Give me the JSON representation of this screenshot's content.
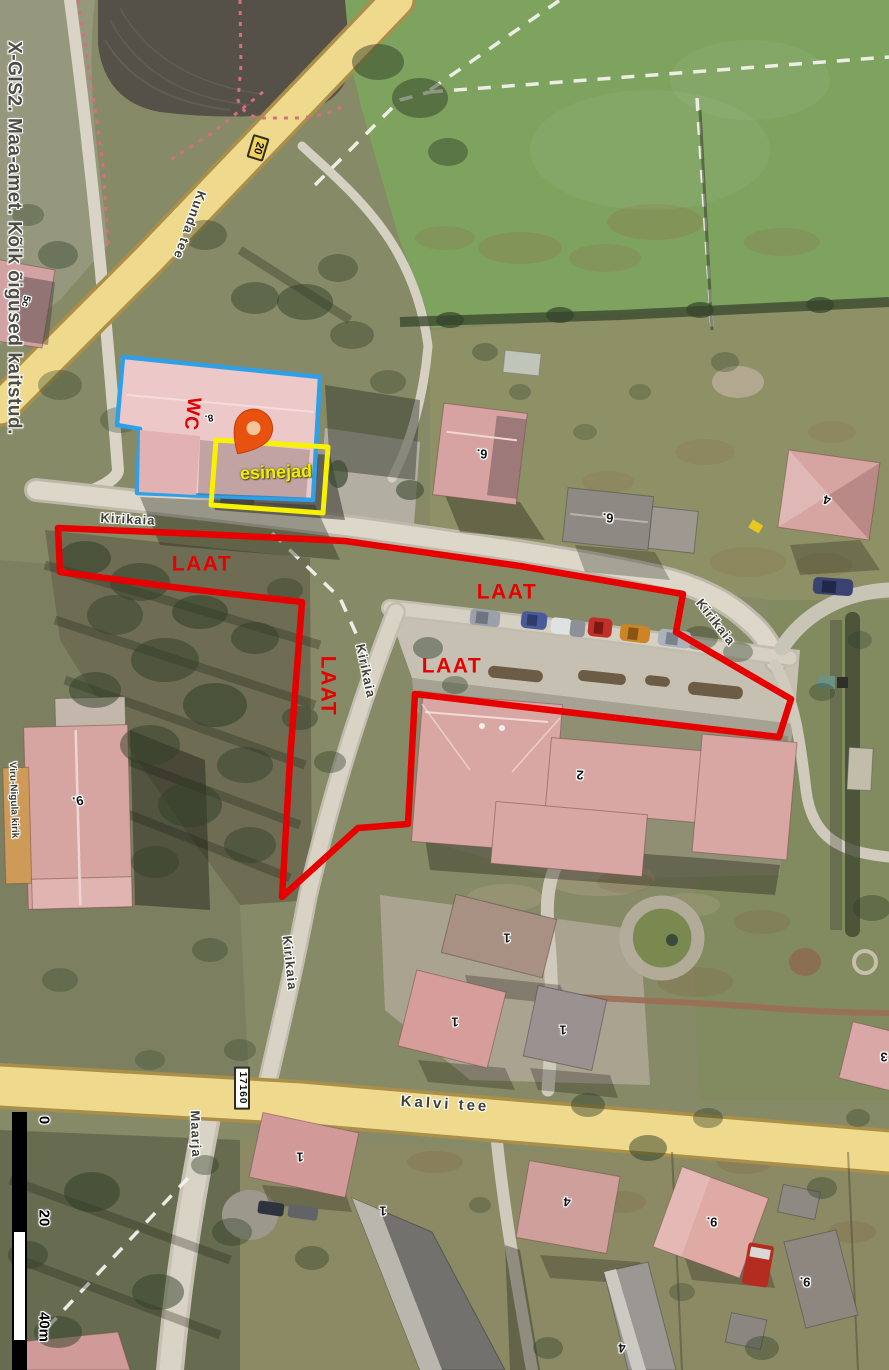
{
  "copyright": "X-GIS2. Maa-amet. Kõik õigused kaitstud.",
  "annotations": {
    "laat1": "LAAT",
    "laat2": "LAAT",
    "laat3": "LAAT",
    "laat4": "LAAT",
    "wc": "WC",
    "esinejad": "esinejad",
    "colors": {
      "event_area_outline": "#e60000",
      "wc_building_outline": "#2f9fe8",
      "stage_area_outline": "#f8f200",
      "location_pin": "#e8520e"
    }
  },
  "roads": {
    "kunda_tee": "Kunda tee",
    "kirikaia": "Kirikaia",
    "kalvi_tee": "Kalvi tee",
    "maarja": "Maarja",
    "route_number_20": "20",
    "route_number_17160": "17160"
  },
  "buildings": {
    "church_name": "Viru-Nigula kirik",
    "labels": {
      "wc_house": "8.",
      "house_5c": "5c",
      "house_6a": "6.",
      "house_6b": "6.",
      "house_4a": "4",
      "church": "9.",
      "school": "2",
      "house_1a": "1",
      "house_1b": "1",
      "house_1c": "1",
      "house_1d": "1",
      "house_1e": "1",
      "house_4b": "4",
      "house_9a": "9.",
      "house_9b": "9.",
      "house_4c": "4",
      "house_3": "3"
    }
  },
  "scale_bar": {
    "tick_0": "0",
    "tick_20": "20",
    "tick_40": "40m"
  }
}
